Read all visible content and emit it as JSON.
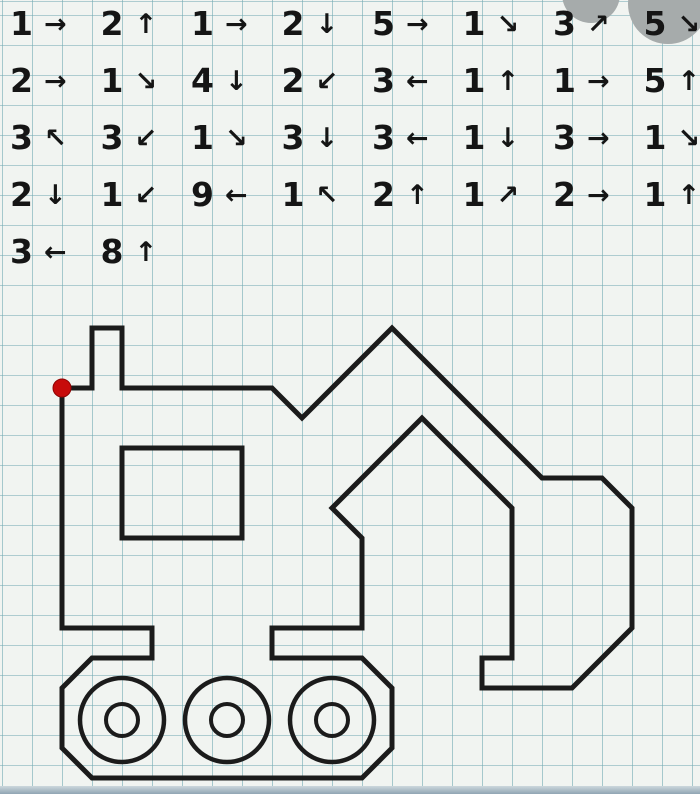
{
  "instructions": {
    "arrow_glyphs": {
      "right": "→",
      "left": "←",
      "up": "↑",
      "down": "↓",
      "up-right": "↗",
      "up-left": "↖",
      "down-right": "↘",
      "down-left": "↙"
    },
    "rows": [
      [
        {
          "count": "1",
          "dir": "right"
        },
        {
          "count": "2",
          "dir": "up"
        },
        {
          "count": "1",
          "dir": "right"
        },
        {
          "count": "2",
          "dir": "down"
        },
        {
          "count": "5",
          "dir": "right"
        },
        {
          "count": "1",
          "dir": "down-right"
        },
        {
          "count": "3",
          "dir": "up-right"
        },
        {
          "count": "5",
          "dir": "down-right"
        }
      ],
      [
        {
          "count": "2",
          "dir": "right"
        },
        {
          "count": "1",
          "dir": "down-right"
        },
        {
          "count": "4",
          "dir": "down"
        },
        {
          "count": "2",
          "dir": "down-left"
        },
        {
          "count": "3",
          "dir": "left"
        },
        {
          "count": "1",
          "dir": "up"
        },
        {
          "count": "1",
          "dir": "right"
        },
        {
          "count": "5",
          "dir": "up"
        }
      ],
      [
        {
          "count": "3",
          "dir": "up-left"
        },
        {
          "count": "3",
          "dir": "down-left"
        },
        {
          "count": "1",
          "dir": "down-right"
        },
        {
          "count": "3",
          "dir": "down"
        },
        {
          "count": "3",
          "dir": "left"
        },
        {
          "count": "1",
          "dir": "down"
        },
        {
          "count": "3",
          "dir": "right"
        },
        {
          "count": "1",
          "dir": "down-right"
        }
      ],
      [
        {
          "count": "2",
          "dir": "down"
        },
        {
          "count": "1",
          "dir": "down-left"
        },
        {
          "count": "9",
          "dir": "left"
        },
        {
          "count": "1",
          "dir": "up-left"
        },
        {
          "count": "2",
          "dir": "up"
        },
        {
          "count": "1",
          "dir": "up-right"
        },
        {
          "count": "2",
          "dir": "right"
        },
        {
          "count": "1",
          "dir": "up"
        }
      ],
      [
        {
          "count": "3",
          "dir": "left"
        },
        {
          "count": "8",
          "dir": "up"
        }
      ]
    ]
  },
  "drawing": {
    "grid_cell_px": 30,
    "start_dot": {
      "x_px": 62,
      "y_px": 388,
      "radius_px": 9
    },
    "cab_window_cells": {
      "x": 2,
      "y": 2,
      "w": 4,
      "h": 3
    },
    "wheels": {
      "centers_px": [
        [
          122,
          720
        ],
        [
          227,
          720
        ],
        [
          332,
          720
        ]
      ],
      "outer_radius_px": 42,
      "inner_radius_px": 16
    }
  },
  "colors": {
    "paper": "#f1f4f1",
    "grid_line": "#76acb4",
    "ink": "#1b1b1b",
    "red_dot": "#c70b0b",
    "watermark_gray": "#a6abab",
    "photo_edge_blue": "#90a5b3"
  }
}
